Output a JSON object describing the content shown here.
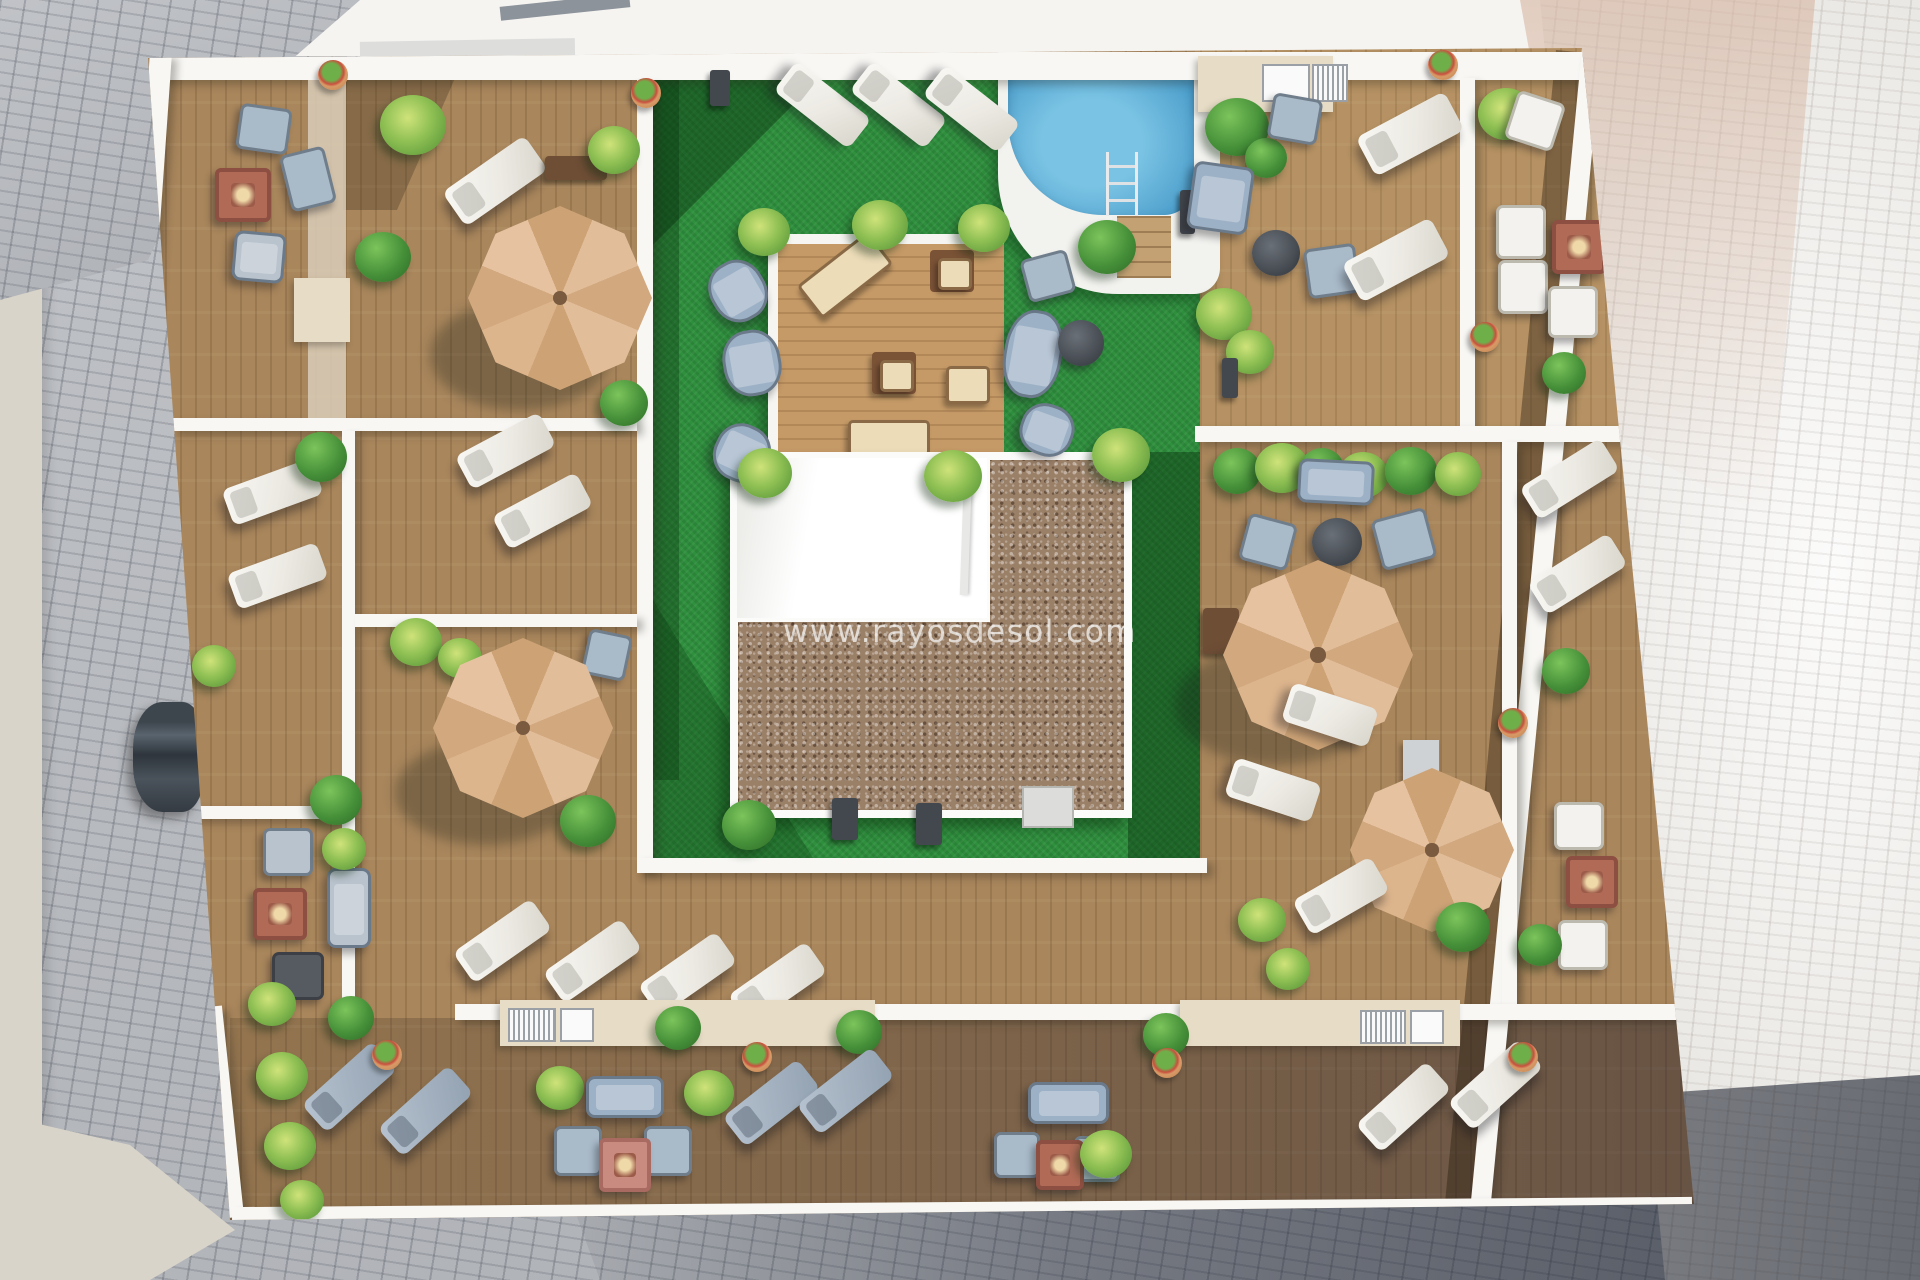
{
  "scene": {
    "type": "aerial-3d-render",
    "description": "Top-down 3D architectural rendering of an apartment-building rooftop solarium: communal pool, artificial-turf garden, raised timber platform, wooden sun decks divided by white privacy walls, parasols, sun loungers, lounge sets and fire-pit tables, surrounded by cobblestone streets with a parked car.",
    "elements": [
      "cobblestone-street",
      "rooftop-terraces",
      "privacy-walls",
      "artificial-turf-garden",
      "swimming-pool",
      "pool-ladder",
      "pool-steps",
      "raised-timber-platform",
      "roof-core-white",
      "roof-core-gravel",
      "parasols",
      "sun-loungers",
      "outdoor-sofas",
      "armchairs",
      "fire-pit-tables",
      "coffee-tables",
      "planters",
      "bushes",
      "palms",
      "outdoor-counters",
      "parked-car",
      "watermark"
    ]
  },
  "watermark": {
    "text": "www.rayosdesol.com"
  },
  "palette": {
    "street_cobble": "#b6b9be",
    "street_light": "#eae8e4",
    "street_pink": "#d6b4a0",
    "wood_deck": "#a9865c",
    "wood_platform": "#c59a67",
    "turf_green": "#2e8f3d",
    "pool_blue": "#4d9fcc",
    "pool_blue_light": "#7ac3e4",
    "wall_white": "#f8f7f4",
    "gravel_brown": "#9b8068",
    "umbrella_beige": "#d8b190",
    "sofa_blue": "#9db1c6",
    "lounger_white": "#f2f0ec",
    "firepit_red": "#b06a56",
    "plant_green": "#47913a"
  }
}
